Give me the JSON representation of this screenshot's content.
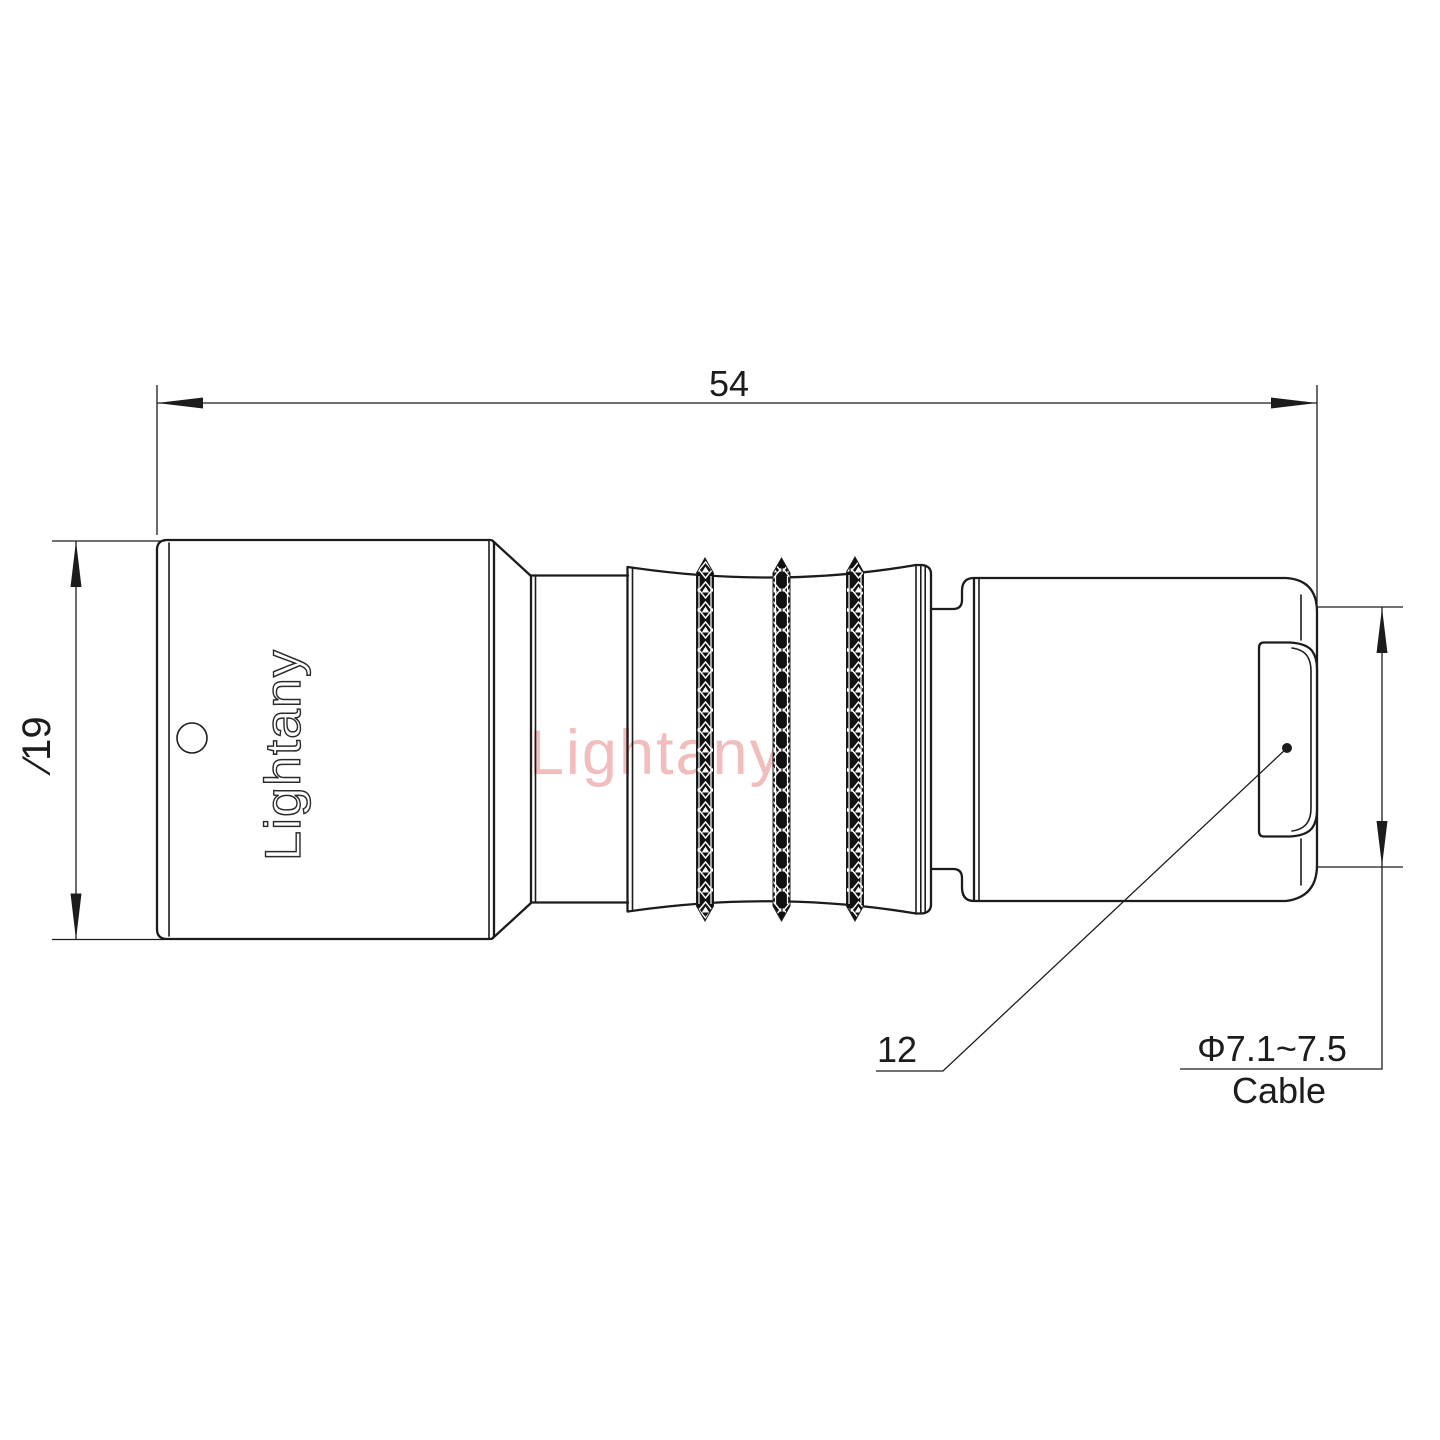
{
  "drawing": {
    "background": "#ffffff",
    "line_color": "#1c1c1c",
    "watermark": {
      "text": "Lightany",
      "color": "#f2bdbd"
    },
    "brand_engraving": "Lightany",
    "dimensions": {
      "overall_length": {
        "value": "54"
      },
      "body_diameter": {
        "value": "∕19"
      },
      "rear_label": {
        "value": "12"
      },
      "cable_note": {
        "diameter_range": "Φ7.1~7.5",
        "label": "Cable"
      }
    }
  }
}
